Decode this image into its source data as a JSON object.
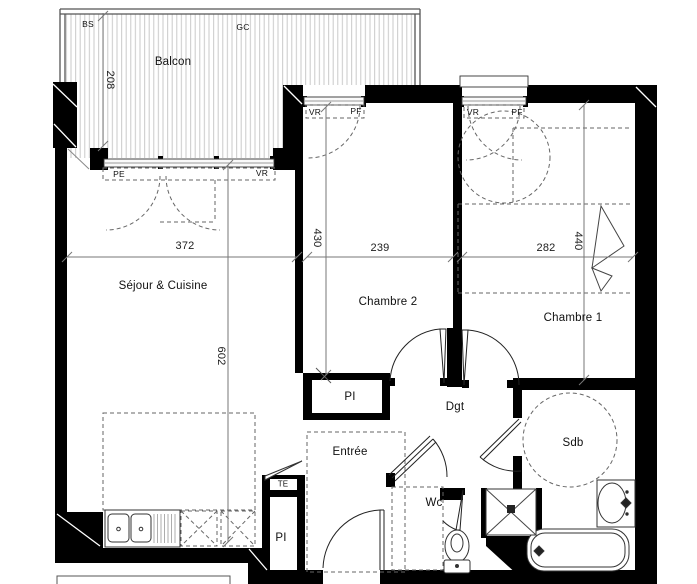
{
  "plan": {
    "type": "apartment-floorplan",
    "rooms": {
      "balcon": "Balcon",
      "sejour": "Séjour & Cuisine",
      "chambre2": "Chambre 2",
      "chambre1": "Chambre 1",
      "dgt": "Dgt",
      "entree": "Entrée",
      "wc": "Wc",
      "sdb": "Sdb",
      "pi_chambre2": "PI",
      "pi_entree": "PI"
    },
    "dimensions_cm": {
      "balcon_depth": "208",
      "sejour_width": "372",
      "sejour_length": "602",
      "chambre2_depth": "430",
      "chambre2_width": "239",
      "chambre1_width": "282",
      "chambre1_depth": "440"
    },
    "annotations": {
      "bs": "BS",
      "gc": "GC",
      "pe": "PE",
      "vr_sejour": "VR",
      "vr_chambre2": "VR",
      "pf_chambre2": "PF",
      "vr_chambre1": "VR",
      "pf_chambre1": "PF",
      "te": "TE"
    },
    "colors": {
      "wall": "#000000",
      "line": "#333333",
      "dashed": "#666666",
      "dimension": "#777777",
      "hatch": "#c9c9c9",
      "background": "#ffffff"
    }
  }
}
